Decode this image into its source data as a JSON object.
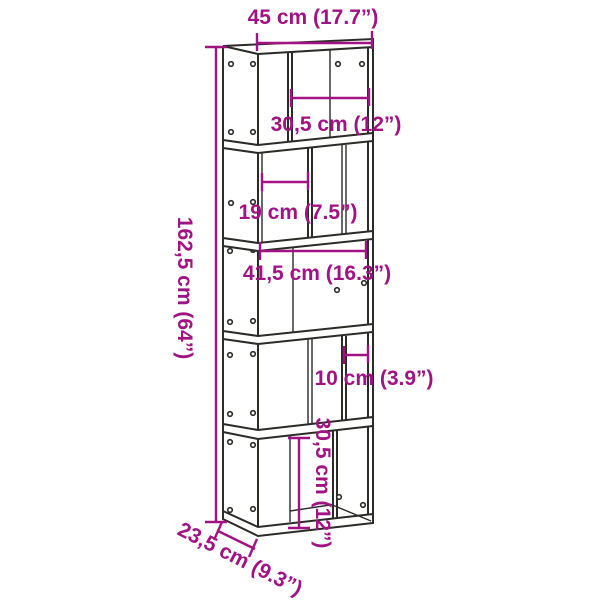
{
  "dims": {
    "overall_width": "45 cm (17.7”)",
    "top_shelf_inner_width": "30,5 cm (12”)",
    "second_shelf_inner_width": "19 cm (7.5”)",
    "middle_shelf_inner_width": "41,5 cm (16.3”)",
    "fourth_shelf_inner_width": "10 cm (3.9”)",
    "bottom_shelf_inner_height": "30,5 cm (12”)",
    "overall_height": "162,5 cm (64”)",
    "overall_depth": "23,5 cm (9.3”)"
  },
  "colors": {
    "dimension": "#a11283",
    "outline": "#2b2b28",
    "background": "#ffffff"
  }
}
